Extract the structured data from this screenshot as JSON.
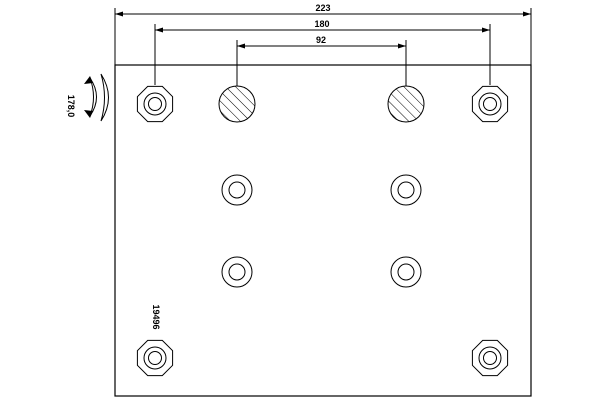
{
  "drawing": {
    "type": "brake-lining-technical-drawing",
    "part_number": "19496",
    "arc_radius_label": "178,0",
    "dimensions": {
      "total_width": "223",
      "outer_hole_spacing": "180",
      "inner_hole_spacing": "92"
    },
    "icons": {
      "curvature_section": "nested-arcs-with-arrows",
      "rivet_hole": "octagon-with-concentric-circles",
      "plugged_hole": "hatched-circle",
      "plain_hole": "concentric-circles"
    },
    "colors": {
      "line": "#000000",
      "background": "#ffffff"
    }
  }
}
